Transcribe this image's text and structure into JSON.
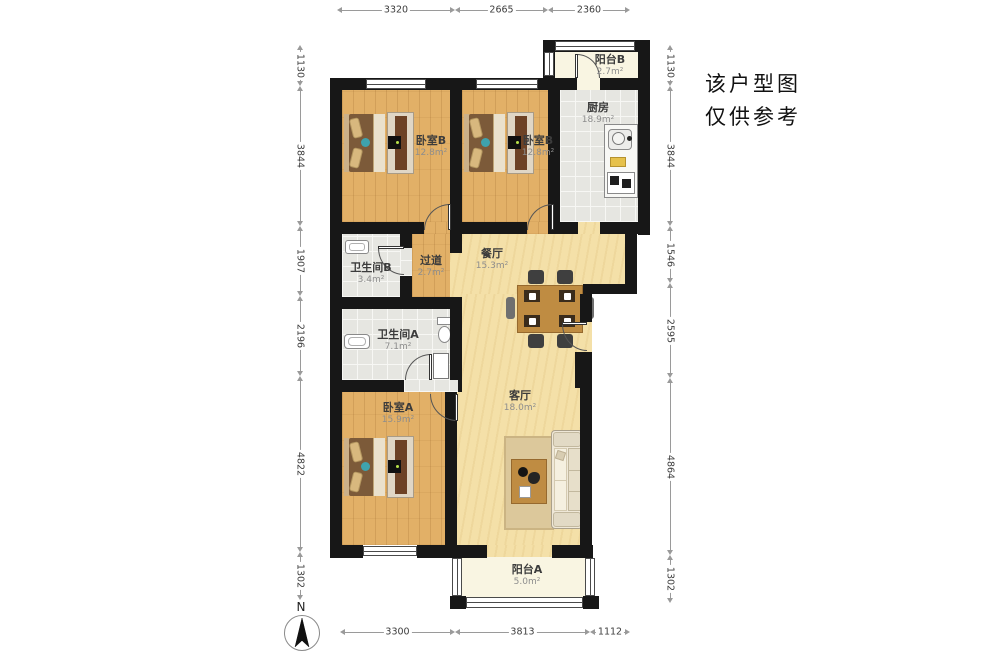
{
  "note": {
    "line1": "该户型图",
    "line2": "仅供参考"
  },
  "north": {
    "label": "N"
  },
  "rooms": {
    "balcony_b": {
      "name": "阳台B",
      "area": "2.7m²"
    },
    "kitchen": {
      "name": "厨房",
      "area": "18.9m²"
    },
    "bedroom_b1": {
      "name": "卧室B",
      "area": "12.8m²"
    },
    "bedroom_b2": {
      "name": "卧室B",
      "area": "12.8m²"
    },
    "dining": {
      "name": "餐厅",
      "area": "15.3m²"
    },
    "hallway": {
      "name": "过道",
      "area": "2.7m²"
    },
    "bath_b": {
      "name": "卫生间B",
      "area": "3.4m²"
    },
    "bath_a": {
      "name": "卫生间A",
      "area": "7.1m²"
    },
    "bedroom_a": {
      "name": "卧室A",
      "area": "15.9m²"
    },
    "living": {
      "name": "客厅",
      "area": "18.0m²"
    },
    "balcony_a": {
      "name": "阳台A",
      "area": "5.0m²"
    }
  },
  "dimensions": {
    "top": [
      "3320",
      "2665",
      "2360"
    ],
    "left": [
      "1130",
      "3844",
      "1907",
      "2196",
      "4822",
      "1302"
    ],
    "right": [
      "1130",
      "3844",
      "1546",
      "2595",
      "4864",
      "1302"
    ],
    "bottom": [
      "3300",
      "3813",
      "1112"
    ]
  },
  "colors": {
    "wall": "#171717",
    "bedroom_floor": "#e2b067",
    "living_floor": "#f4e0a8",
    "tile_floor": "#e6e6e1",
    "balcony_floor": "#f9f5e2",
    "accent_teal": "#3fa3ad"
  }
}
